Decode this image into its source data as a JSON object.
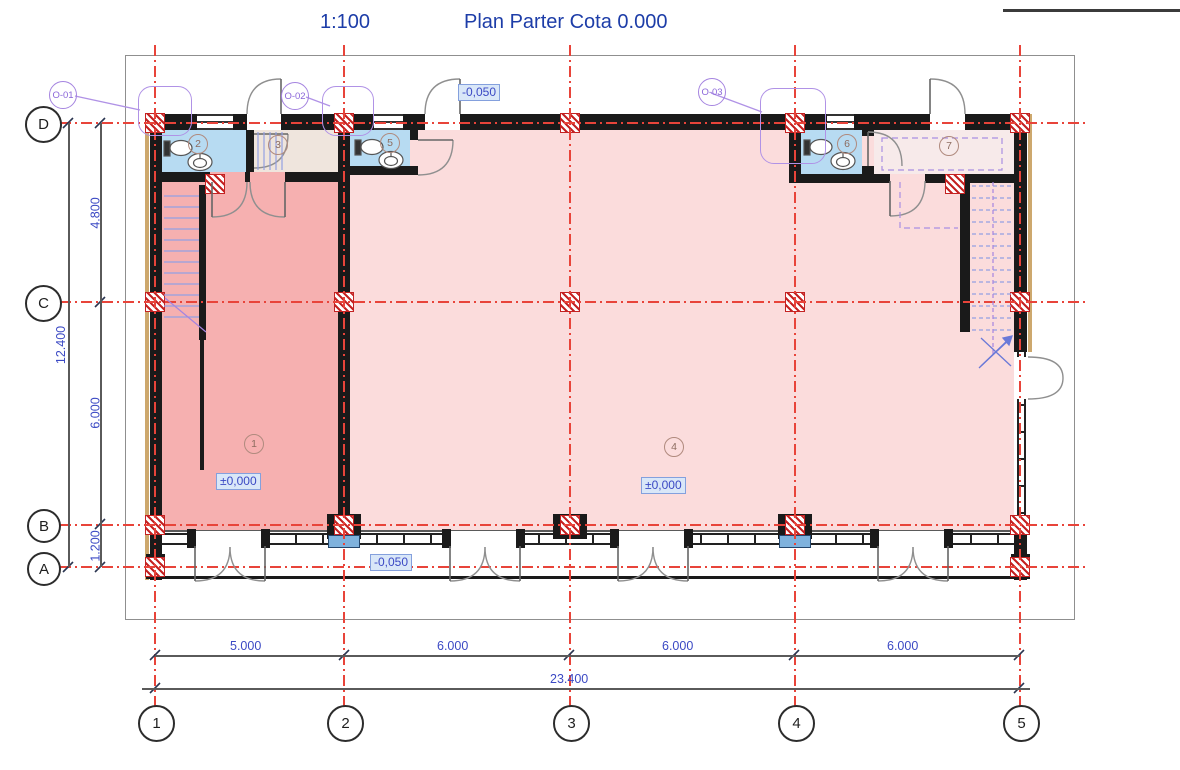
{
  "title": {
    "scale": "1:100",
    "name": "Plan Parter Cota 0.000"
  },
  "grid": {
    "cols": [
      {
        "label": "1"
      },
      {
        "label": "2"
      },
      {
        "label": "3"
      },
      {
        "label": "4"
      },
      {
        "label": "5"
      }
    ],
    "rows": [
      {
        "label": "D"
      },
      {
        "label": "C"
      },
      {
        "label": "B"
      },
      {
        "label": "A"
      }
    ]
  },
  "dims": {
    "bottom": [
      "5.000",
      "6.000",
      "6.000",
      "6.000"
    ],
    "bottom_total": "23.400",
    "left": [
      "4.800",
      "6.000",
      "1.200"
    ],
    "left_total": "12.400"
  },
  "rooms": [
    {
      "number": "1"
    },
    {
      "number": "2"
    },
    {
      "number": "3"
    },
    {
      "number": "4"
    },
    {
      "number": "5"
    },
    {
      "number": "6"
    },
    {
      "number": "7"
    }
  ],
  "elevations": {
    "room1": "±0,000",
    "room4": "±0,000",
    "top": "-0,050",
    "porch": "-0,050"
  },
  "window_tags": [
    {
      "label": "O-01"
    },
    {
      "label": "O-02"
    },
    {
      "label": "O-03"
    }
  ],
  "colors": {
    "title_blue": "#1d3da8",
    "dimension_blue": "#3b49c4",
    "grid_red": "#e8443a",
    "column_red": "#c42222",
    "wall_black": "#1a1a1a",
    "room1_pink": "#f6b0b0",
    "room4_pink": "#fbdcdc",
    "wc_blue": "#b7dbf2",
    "room3_beige": "#efe5dd",
    "room7_pink": "#f7eaea",
    "tag_purple": "#a584e0",
    "stair_blue": "#94a0e2",
    "insulation_tan": "#cda86d",
    "sill_blue": "#7fb2dd"
  }
}
